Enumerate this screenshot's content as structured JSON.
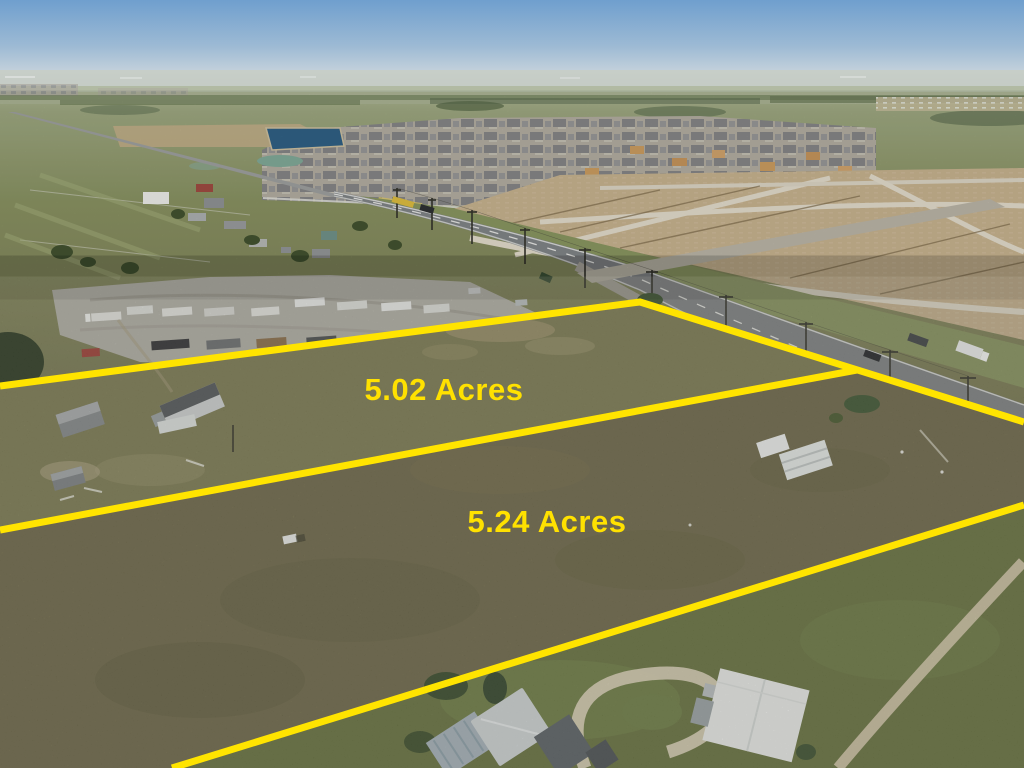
{
  "overlay": {
    "line_color": "#FFE400",
    "label_color": "#FFE100",
    "parcels": [
      {
        "label": "5.02 Acres"
      },
      {
        "label": "5.24 Acres"
      }
    ]
  },
  "palette": {
    "sky_top": "#76A3CF",
    "sky_horizon": "#D3DADD",
    "pasture_green": "#8F9A6E",
    "parcel_grass_dark": "#6E6849",
    "graded_dirt": "#C3AD8A",
    "asphalt": "#7E8284",
    "gravel_yard": "#B2B0A8"
  }
}
